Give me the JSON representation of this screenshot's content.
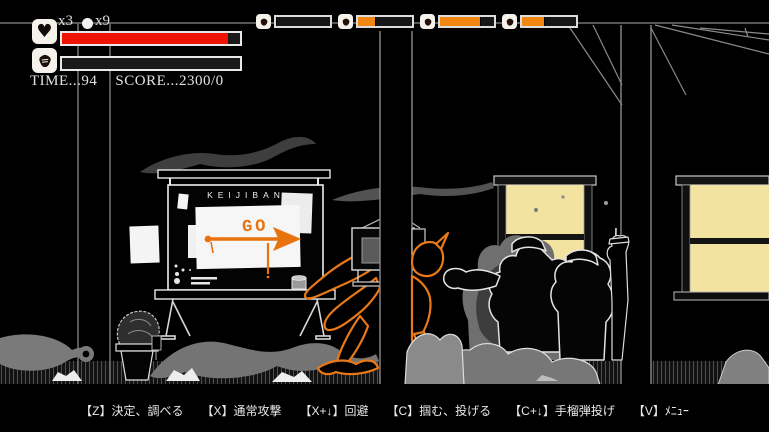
{
  "hud": {
    "lives_count": "x3",
    "orbs_count": "x9",
    "health_percent": 93,
    "stamina_percent": 0,
    "time_label": "TIME...94",
    "score_label": "SCORE...2300/0"
  },
  "weapon_slots": [
    {
      "icon": "grenade-icon",
      "fill_percent": 0
    },
    {
      "icon": "grenade-icon",
      "fill_percent": 33
    },
    {
      "icon": "grenade-icon",
      "fill_percent": 76
    },
    {
      "icon": "grenade-icon",
      "fill_percent": 42
    }
  ],
  "scene": {
    "signboard_title": "KEIJIBAN",
    "graffiti_text": "GO",
    "graffiti_arrow": "right-arrow",
    "colors": {
      "health_red": "#ee1400",
      "gauge_orange": "#f08511",
      "graffiti_orange": "#e8720e",
      "player_outline_orange": "#e87818",
      "window_glow_yellow": "#f2e3a1",
      "smoke_gray": "#747474"
    }
  },
  "controls": [
    "【Z】決定、調べる",
    "【X】通常攻撃",
    "【X+↓】回避",
    "【C】掴む、投げる",
    "【C+↓】手榴弾投げ",
    "【V】ﾒﾆｭｰ"
  ]
}
